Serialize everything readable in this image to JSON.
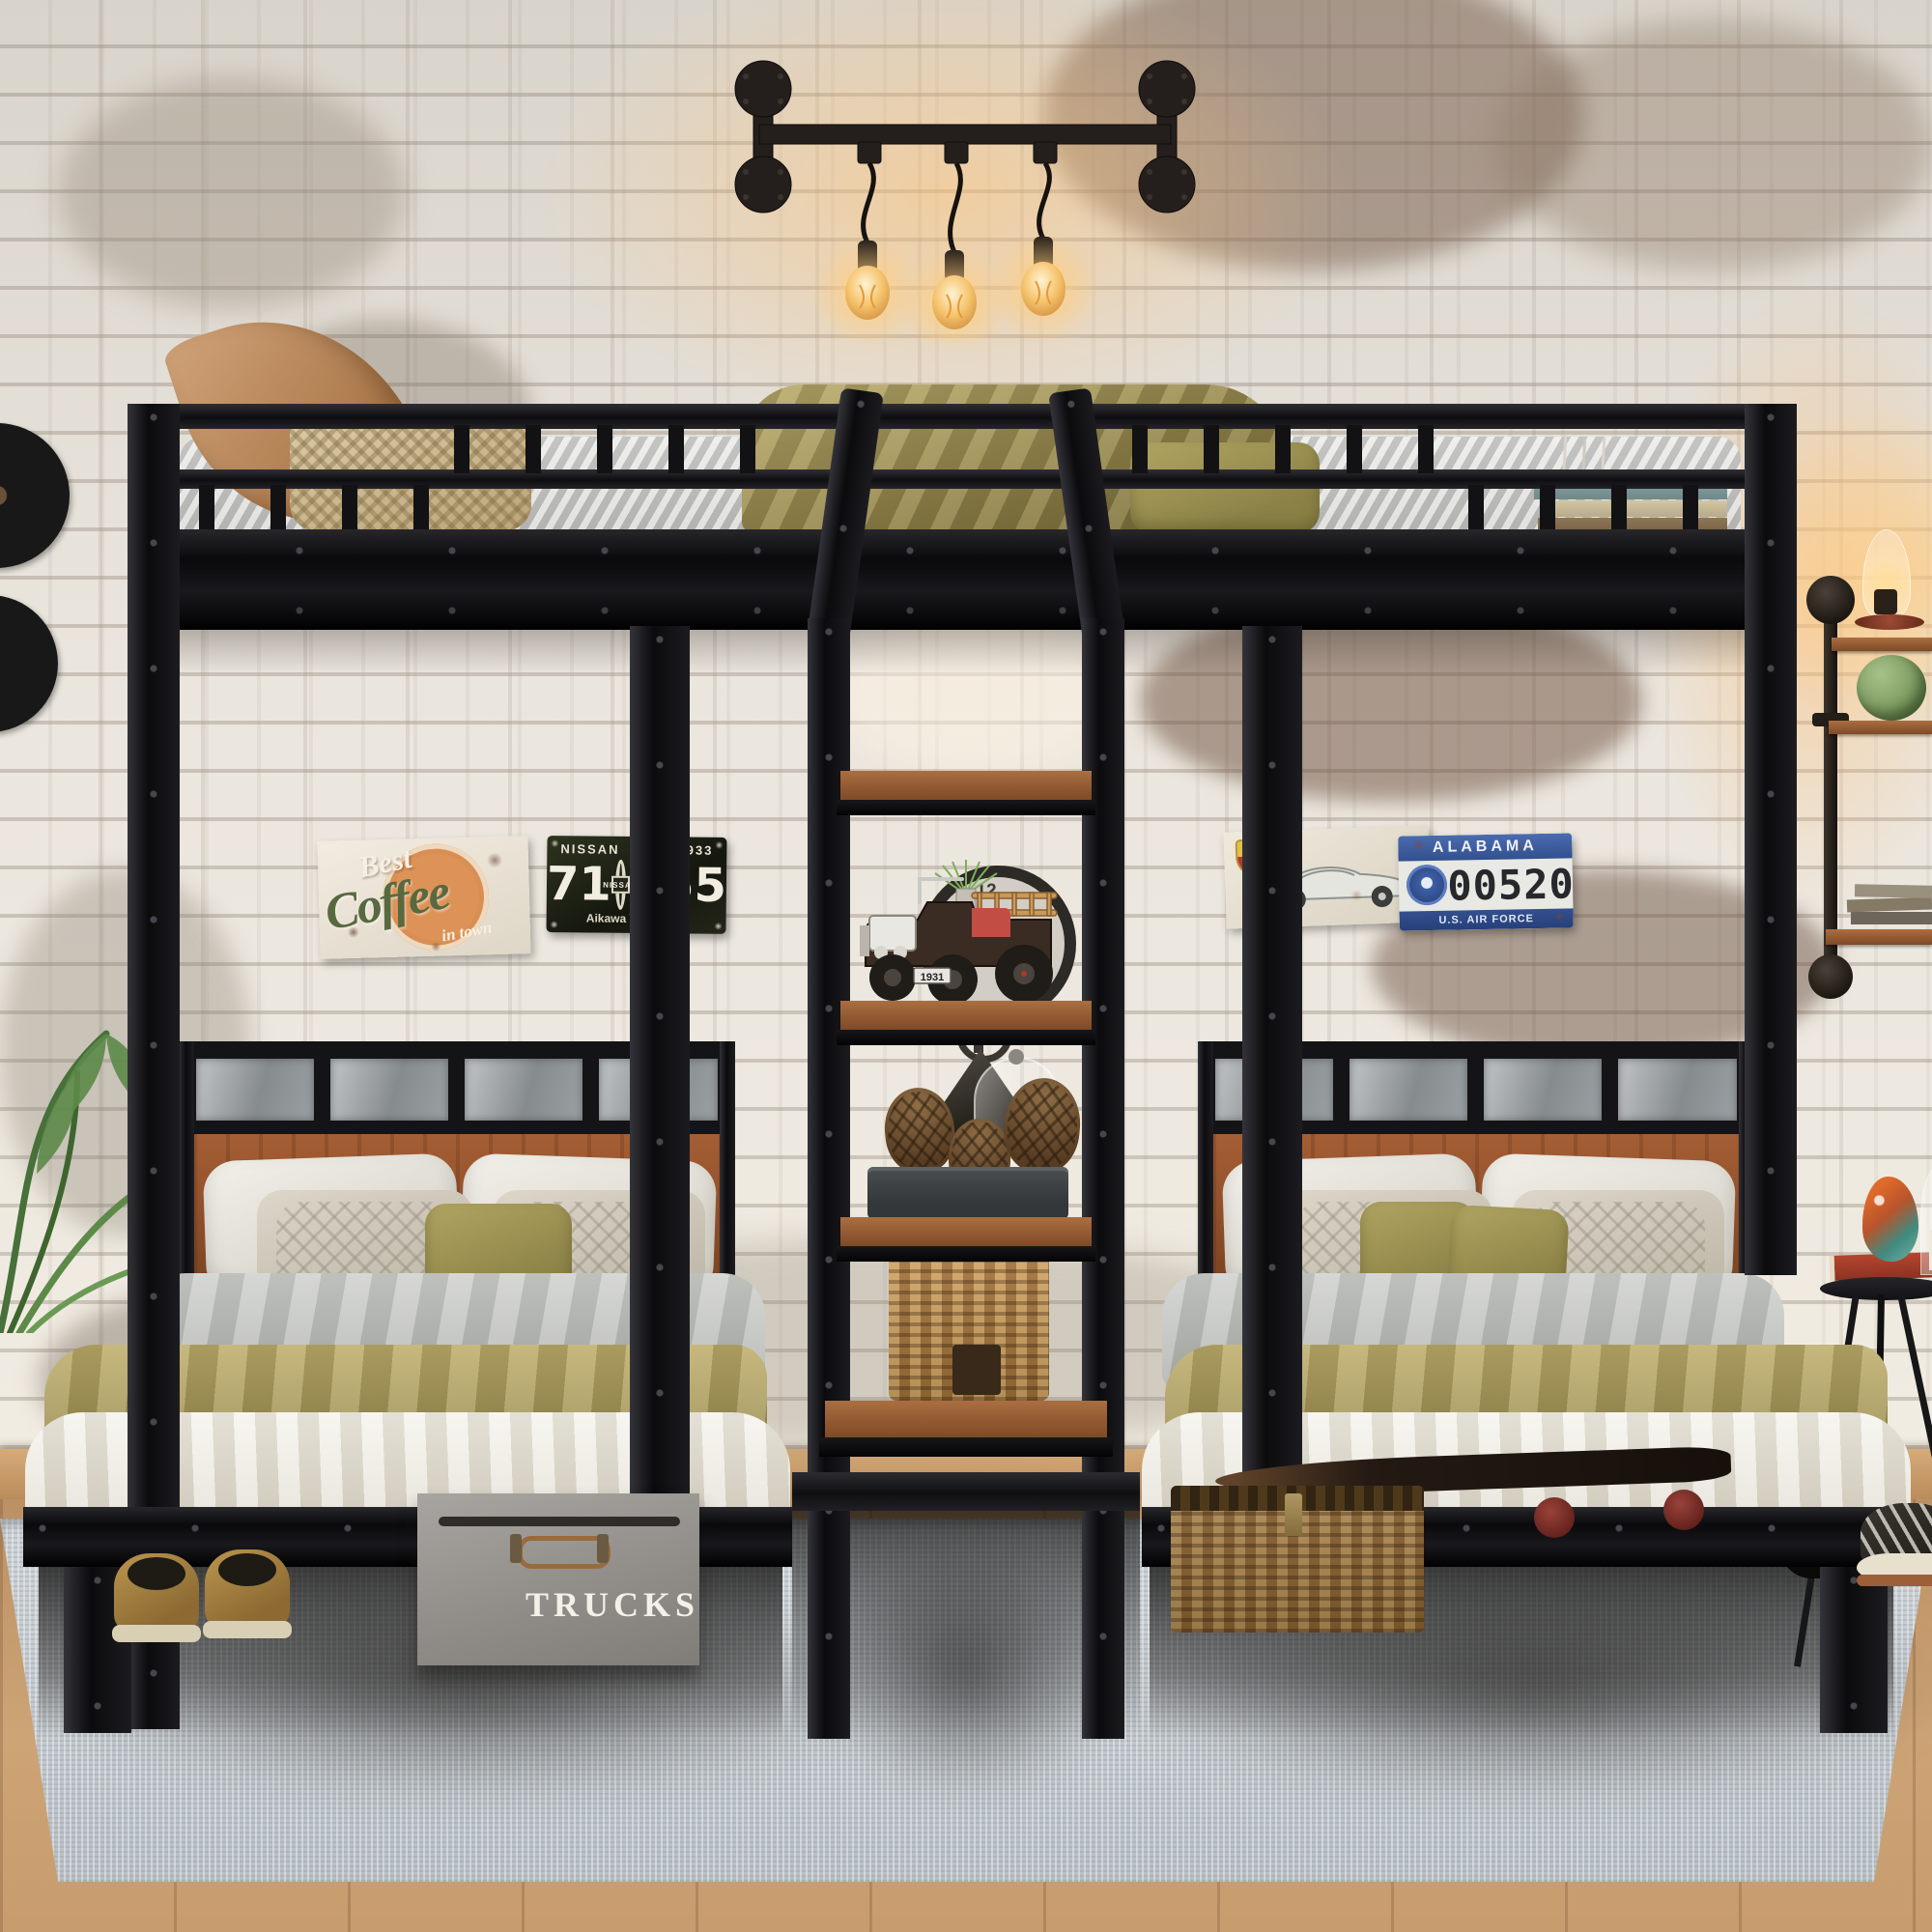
{
  "signs": {
    "coffee": {
      "best": "Best",
      "coffee": "Coffee",
      "tagline": "in town"
    },
    "nissan": {
      "top_left": "NISSAN",
      "top_right": "933",
      "num_left": "71",
      "num_right": "555",
      "brand": "NISSAN",
      "bottom": "Aikawa Yoshisuke"
    },
    "alabama": {
      "state": "ALABAMA",
      "number": "00520",
      "bottom": "U.S. AIR FORCE"
    }
  },
  "storage_box": {
    "label": "TRUCKS"
  },
  "toy_truck": {
    "plate": "1931"
  },
  "clock": {
    "numeral": "12"
  },
  "palette": {
    "frame_black": "#141416",
    "wall_base": "#e9e4dc",
    "shelf_wood": "#9a5a32",
    "headboard_wood": "#9d5a33",
    "olive_bedding": "#a89a58",
    "gray_duvet": "#c3c5c3",
    "white_linen": "#efece3",
    "rug": "#ccd1d5",
    "floor_wood": "#c19468",
    "warm_glow": "#ffc87d",
    "basket_tan": "#c29a5e",
    "box_gray": "#9c9995",
    "wheel_red": "#a8362c",
    "plant_green": "#5d8a49",
    "plate_blue": "#3c5fa6",
    "coffee_orange": "#d98f54",
    "coffee_green": "#5c6b44"
  }
}
